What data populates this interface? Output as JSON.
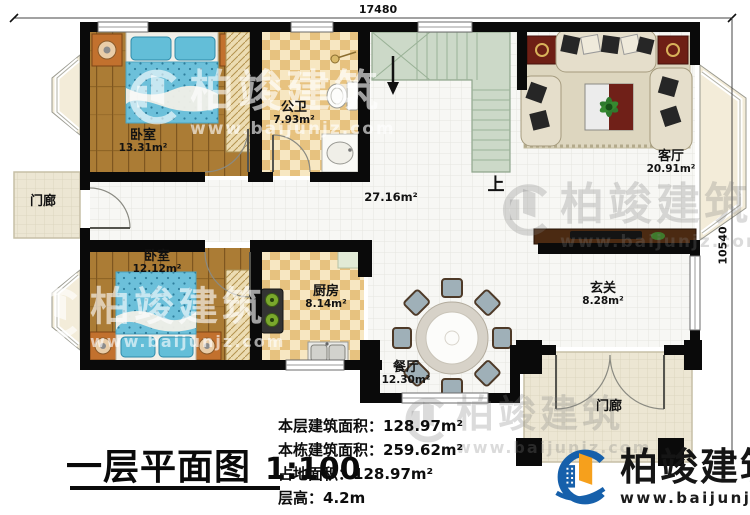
{
  "plan": {
    "dim_top": "17480",
    "dim_right": "10540",
    "labels": {
      "bedroom1": {
        "name": "卧室",
        "area": "13.31m²"
      },
      "bedroom2": {
        "name": "卧室",
        "area": "12.12m²"
      },
      "bathroom": {
        "name": "公卫",
        "area": "7.93m²"
      },
      "living": {
        "name": "客厅",
        "area": "20.91m²"
      },
      "kitchen": {
        "name": "厨房",
        "area": "8.14m²"
      },
      "dining": {
        "name": "餐厅",
        "area": "12.30m²"
      },
      "entry": {
        "name": "玄关",
        "area": "8.28m²"
      },
      "hall_area": "27.16m²",
      "porch_left": "门廊",
      "porch_bottom": "门廊",
      "stairs_up": "上"
    }
  },
  "title_block": {
    "title": "一层平面图",
    "scale": "1:100",
    "stats": [
      {
        "label": "本层建筑面积：",
        "value": "128.97m²"
      },
      {
        "label": "本栋建筑面积：",
        "value": "259.62m²"
      },
      {
        "label": "占地面积：",
        "value": "128.97m²"
      },
      {
        "label": "层高：",
        "value": "4.2m"
      }
    ]
  },
  "branding": {
    "company": "柏竣建筑",
    "website": "www.baijunjz.com"
  },
  "watermark": {
    "company": "柏竣建筑",
    "website": "www.baijunjz.com"
  },
  "colors": {
    "wall": "#0a0a0a",
    "wood": "#ab7c35",
    "checker": "#e7c27f",
    "stairs": "#ccd9c8",
    "logo_blue": "#1660ab",
    "logo_orange": "#f6a01c"
  }
}
